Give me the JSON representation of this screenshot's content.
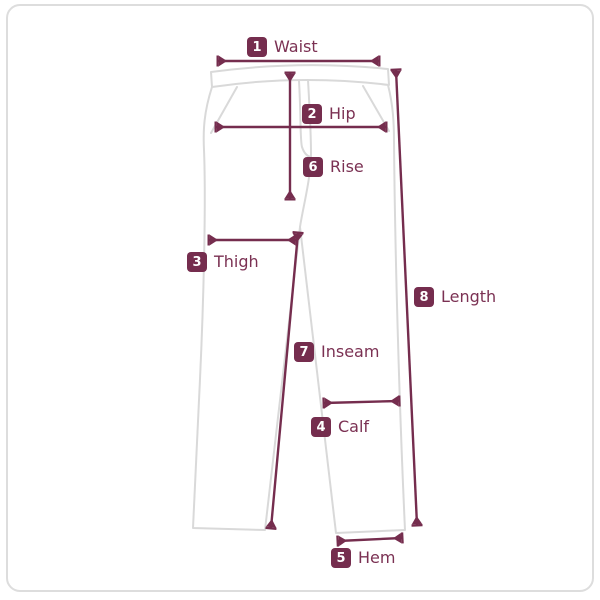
{
  "diagram_type": "pants-size-measurement-guide",
  "measurements": [
    {
      "number": "1",
      "label": "Waist"
    },
    {
      "number": "2",
      "label": "Hip"
    },
    {
      "number": "3",
      "label": "Thigh"
    },
    {
      "number": "4",
      "label": "Calf"
    },
    {
      "number": "5",
      "label": "Hem"
    },
    {
      "number": "6",
      "label": "Rise"
    },
    {
      "number": "7",
      "label": "Inseam"
    },
    {
      "number": "8",
      "label": "Length"
    }
  ],
  "colors": {
    "accent": "#752d4e",
    "label_text": "#7b3153",
    "badge_text": "#ffffff",
    "outline": "#d9d9d9",
    "frame_border": "#dddddd",
    "background": "#ffffff"
  }
}
